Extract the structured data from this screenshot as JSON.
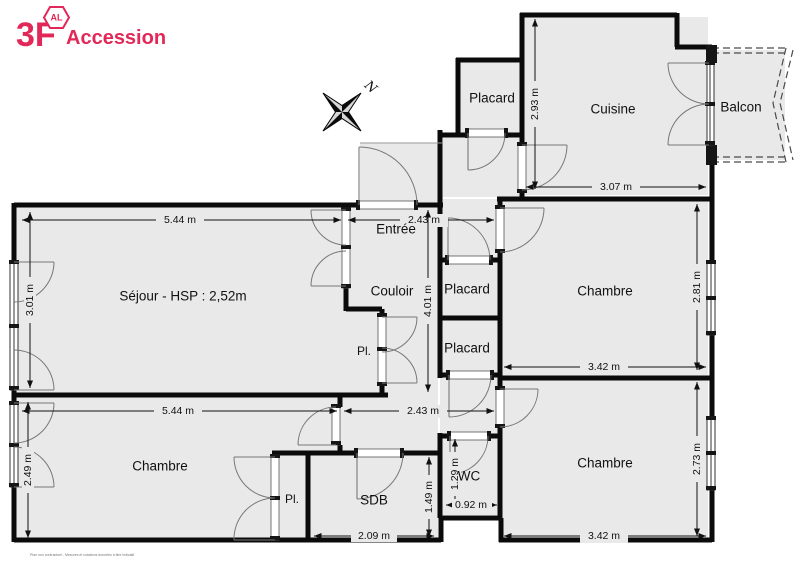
{
  "brand": {
    "logo_main": "3F",
    "logo_badge": "AL",
    "logo_sub": "Accession",
    "color": "#E22858"
  },
  "compass": {
    "north_label": "N"
  },
  "labels": {
    "placard_haut": "Placard",
    "cuisine": "Cuisine",
    "balcon": "Balcon",
    "entree": "Entrée",
    "sejour": "Séjour - HSP : 2,52m",
    "couloir": "Couloir",
    "placard1": "Placard",
    "placard2": "Placard",
    "pl_couloir": "Pl.",
    "pl_chambre": "Pl.",
    "chambre_ne": "Chambre",
    "chambre_sw": "Chambre",
    "chambre_se": "Chambre",
    "sdb": "SDB",
    "wc": "WC"
  },
  "dims": {
    "cuisine_h": "2.93 m",
    "cuisine_l": "3.07 m",
    "sejour_l": "5.44 m",
    "sejour_w": "3.01 m",
    "entree_l": "2.43 m",
    "couloir_h": "4.01 m",
    "chambre_ne_l": "3.42 m",
    "chambre_ne_w": "2.81 m",
    "chambre_sw_l": "5.44 m",
    "chambre_sw_w": "2.49 m",
    "couloir_s": "2.43 m",
    "sdb_l": "2.09 m",
    "sdb_w": "1.49 m",
    "wc_h": "1.29 m",
    "wc_w": "0.92 m",
    "chambre_se_l": "3.42 m",
    "chambre_se_w": "2.73 m"
  },
  "footer": {
    "disclaimer": "Plan non contractuel - Mesures et cotations données à titre indicatif"
  }
}
